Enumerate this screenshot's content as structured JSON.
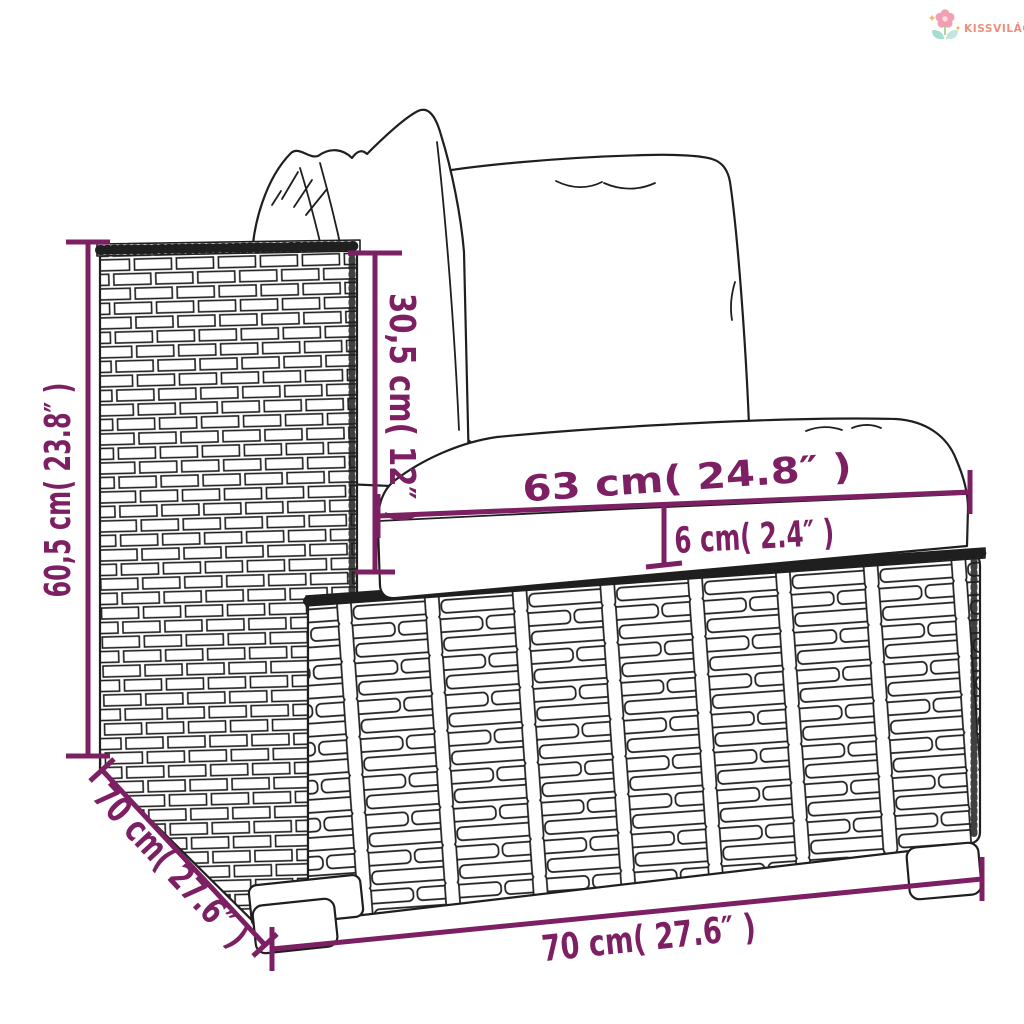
{
  "brand": {
    "name": "KISSVILÁG"
  },
  "measurements": {
    "overall_height": "60,5 cm( 23.8″ )",
    "backrest_height": "30,5 cm( 12″ )",
    "seat_cushion_width": "63 cm( 24.8″ )",
    "seat_cushion_thickness": "6 cm( 2.4″ )",
    "depth": "70 cm( 27.6″ )",
    "width": "70 cm( 27.6″ )"
  },
  "colors": {
    "dimension_accent": "#7d2063",
    "sketch_outline": "#1f1f1f",
    "logo_text": "#ef8d7d",
    "logo_flower_petal": "#f29fb4",
    "logo_flower_center": "#fbdde4",
    "logo_leaf": "#a9dbd0",
    "logo_sparkle": "#f3b163"
  }
}
